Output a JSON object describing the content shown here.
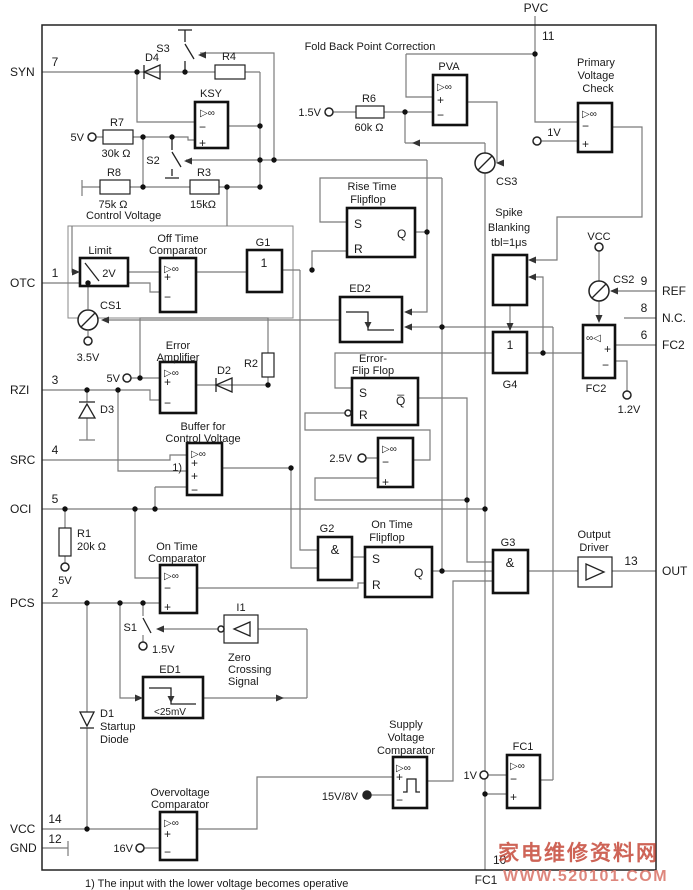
{
  "pins": {
    "syn": {
      "label": "SYN",
      "num": "7"
    },
    "otc": {
      "label": "OTC",
      "num": "1"
    },
    "rzi": {
      "label": "RZI",
      "num": "3"
    },
    "src": {
      "label": "SRC",
      "num": "4"
    },
    "oci": {
      "label": "OCI",
      "num": "5"
    },
    "pcs": {
      "label": "PCS",
      "num": "2"
    },
    "vcc": {
      "label": "VCC",
      "num": "14"
    },
    "gnd": {
      "label": "GND",
      "num": "12"
    },
    "pvc": {
      "label": "PVC",
      "num": "11"
    },
    "ref": {
      "label": "REF",
      "num": "9"
    },
    "nc": {
      "label": "N.C.",
      "num": "8"
    },
    "fc2": {
      "label": "FC2",
      "num": "6"
    },
    "out": {
      "label": "OUT",
      "num": "13"
    },
    "fc1": {
      "label": "FC1",
      "num": "10"
    }
  },
  "blocks": {
    "fold_back": "Fold Back Point Correction",
    "pva": "PVA",
    "ksy": "KSY",
    "primary": [
      "Primary",
      "Voltage",
      "Check"
    ],
    "rise_time_ff": [
      "Rise Time",
      "Flipflop"
    ],
    "spike_blanking": [
      "Spike",
      "Blanking",
      "tbl=1μs"
    ],
    "limit": {
      "label": "Limit",
      "value": "2V"
    },
    "off_time_comparator": [
      "Off Time",
      "Comparator"
    ],
    "on_time_comparator": [
      "On Time",
      "Comparator"
    ],
    "error_amplifier": [
      "Error",
      "Amplifier"
    ],
    "error_ff": [
      "Error-",
      "Flip Flop"
    ],
    "buffer": [
      "Buffer for",
      "Control Voltage"
    ],
    "on_time_ff": [
      "On Time",
      "Flipflop"
    ],
    "output_driver": [
      "Output",
      "Driver"
    ],
    "zero_crossing": [
      "Zero",
      "Crossing",
      "Signal"
    ],
    "supply_voltage_comparator": [
      "Supply",
      "Voltage",
      "Comparator"
    ],
    "overvoltage_comparator": [
      "Overvoltage",
      "Comparator"
    ],
    "startup_diode": [
      "D1",
      "Startup",
      "Diode"
    ],
    "ed1": {
      "label": "ED1",
      "value": "<25mV"
    },
    "ed2": "ED2",
    "g1": "G1",
    "g2": "G2",
    "g3": "G3",
    "g4": "G4",
    "fc1": "FC1",
    "fc2": "FC2",
    "i1": "I1",
    "cs1": "CS1",
    "cs2": "CS2",
    "cs3": "CS3",
    "s1": "S1",
    "s2": "S2",
    "s3": "S3",
    "d2": "D2",
    "d3": "D3",
    "d4": "D4",
    "control_voltage": "Control Voltage"
  },
  "resistors": {
    "r1": {
      "name": "R1",
      "value": "20k Ω"
    },
    "r2": {
      "name": "R2"
    },
    "r3": {
      "name": "R3",
      "value": "15kΩ"
    },
    "r4": {
      "name": "R4"
    },
    "r6": {
      "name": "R6",
      "value": "60k Ω"
    },
    "r7": {
      "name": "R7",
      "value": "30k Ω"
    },
    "r8": {
      "name": "R8",
      "value": "75k Ω"
    }
  },
  "voltages": {
    "v5": "5V",
    "v3_5": "3.5V",
    "v1_5": "1.5V",
    "v1": "1V",
    "v1_2": "1.2V",
    "v2_5": "2.5V",
    "v16": "16V",
    "v15_8": "15V/8V",
    "vcc": "VCC"
  },
  "ff": {
    "s": "S",
    "r": "R",
    "q": "Q",
    "qbar": "Q̅"
  },
  "gates": {
    "or": "1",
    "and": "&"
  },
  "signs": {
    "plus": "+",
    "minus": "−"
  },
  "symbols": {
    "comparator": "▷∞",
    "comparator_mirror": "∞◁"
  },
  "footnote_mark": "1)",
  "footnote": "1) The input with the lower voltage becomes operative",
  "watermark": {
    "line1": "家电维修资料网",
    "line2": "WWW.520101.COM"
  }
}
